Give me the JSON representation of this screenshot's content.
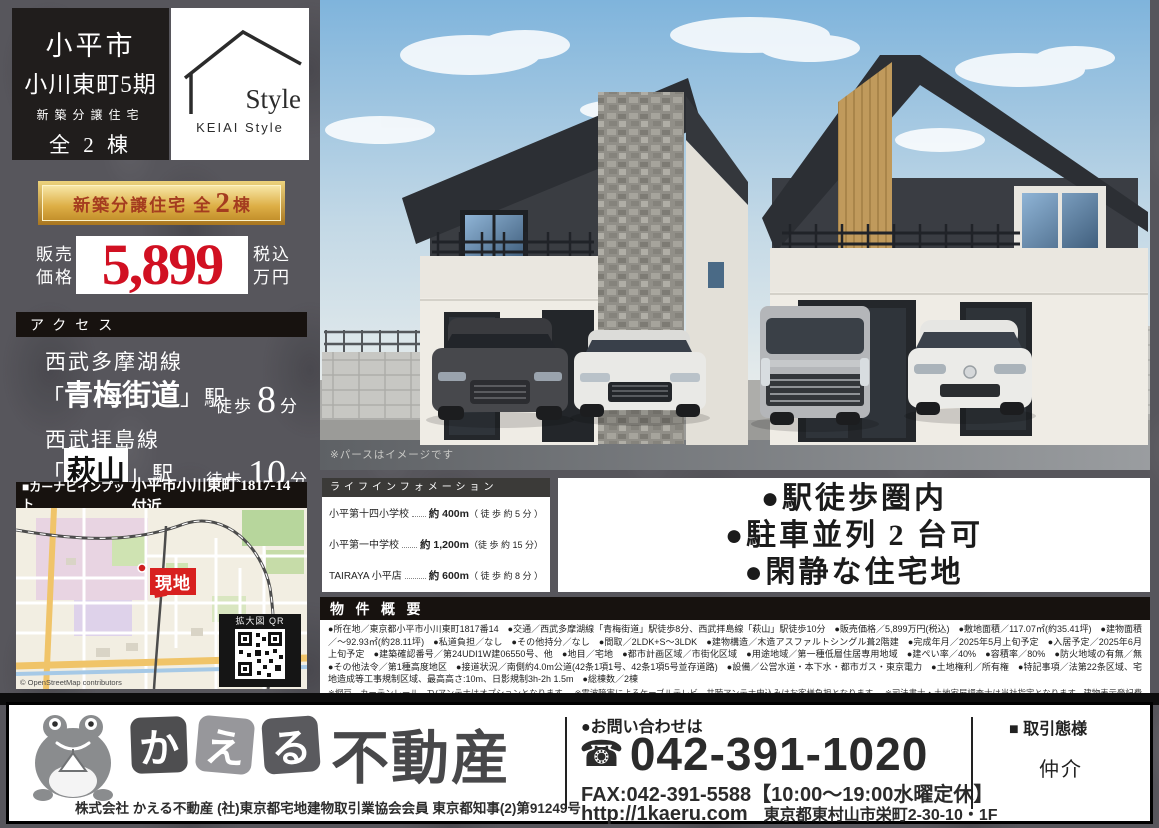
{
  "title_block": {
    "city": "小平市",
    "name": "小川東町5期",
    "subtitle": "新築分譲住宅",
    "count": "全 2 棟",
    "brand_name": "Style",
    "brand_sub": "KEIAI  Style"
  },
  "banner": {
    "label": "新築分譲住宅 全",
    "number": "2",
    "unit": "棟"
  },
  "price": {
    "label_top": "販売",
    "label_bottom": "価格",
    "amount": "5,899",
    "tax_top": "税込",
    "tax_bottom": "万円"
  },
  "access": {
    "header": "アクセス",
    "stations": [
      {
        "line": "西武多摩湖線",
        "bracket_open": "「",
        "name": "青梅街道",
        "bracket_close": "」",
        "suffix": "駅",
        "walk": "徒歩",
        "minutes": "8",
        "unit": "分"
      },
      {
        "line": "西武拝島線",
        "bracket_open": "「",
        "name": "萩山",
        "bracket_close": "」",
        "suffix": "駅",
        "walk": "徒歩",
        "minutes": "10",
        "unit": "分"
      }
    ]
  },
  "navi": {
    "label": "■カーナビインプット",
    "address": "小平市小川東町 1817-14 付近",
    "site_badge": "現地",
    "qr_label": "拡大図 QR",
    "attribution": "© OpenStreetMap contributors"
  },
  "rendering": {
    "note": "※パースはイメージです"
  },
  "life_info": {
    "header": "ライフインフォメーション",
    "items": [
      {
        "name": "小平第十四小学校",
        "distance": "約 400m",
        "walk": "（ 徒 歩 約 5 分 ）"
      },
      {
        "name": "小平第一中学校",
        "distance": "約 1,200m",
        "walk": "（徒 歩 約 15 分）"
      },
      {
        "name": "TAIRAYA 小平店",
        "distance": "約 600m",
        "walk": "（ 徒 歩 約 8 分 ）"
      }
    ]
  },
  "features": {
    "items": [
      "●駅徒歩圏内",
      "●駐車並列 2 台可",
      "●閑静な住宅地"
    ]
  },
  "overview": {
    "header": "物 件 概 要",
    "body": "●所在地／東京都小平市小川東町1817番14　●交通／西武多摩湖線「青梅街道」駅徒歩8分、西武拝島線「萩山」駅徒歩10分　●販売価格／5,899万円(税込)　●敷地面積／117.07㎡(約35.41坪)　●建物面積／〜92.93㎡(約28.11坪)　●私道負担／なし　●その他持分／なし　●間取／2LDK+S〜3LDK　●建物構造／木造アスファルトシングル葺2階建　●完成年月／2025年5月上旬予定　●入居予定／2025年6月上旬予定　●建築確認番号／第24UDI1W建06550号、他　●地目／宅地　●都市計画区域／市街化区域　●用途地域／第一種低層住居専用地域　●建ぺい率／40%　●容積率／80%　●防火地域の有無／無　●その他法令／第1種高度地区　●接道状況／南側約4.0m公道(42条1項1号、42条1項5号並存道路)　●設備／公営水道・本下水・都市ガス・東京電力　●土地権利／所有権　●特記事項／法第22条区域、宅地造成等工事規制区域、最高高さ:10m、日影規制3h-2h 1.5m　●総棟数／2棟",
    "notes": "※網戸、カーテンレール、TVアンテナはオプションとなります。　※電波障害によるケーブルテレビ、共聴アンテナ申込みはお客様負担となります。　※司法書士・土地家屋調査士は当社指定となります。建物表示登記費用:102,000円(税込)　※税込とは消費税込のことです。　※広告作成中に売約になる場合がございます。　※図面と現況が異なる場合は現況を優先とさせて頂きます。"
  },
  "footer": {
    "logo_tiles": [
      "か",
      "え",
      "る"
    ],
    "logo_suffix": "不動産",
    "license": "株式会社 かえる不動産 (社)東京都宅地建物取引業協会会員 東京都知事(2)第91249号",
    "contact_label": "●お問い合わせは",
    "phone": "042-391-1020",
    "fax": "FAX:042-391-5588【10:00〜19:00水曜定休】",
    "url": "http://1kaeru.com",
    "address": "東京都東村山市栄町2-30-10・1F",
    "deal_label": "■ 取引態様",
    "deal_type": "仲介"
  }
}
